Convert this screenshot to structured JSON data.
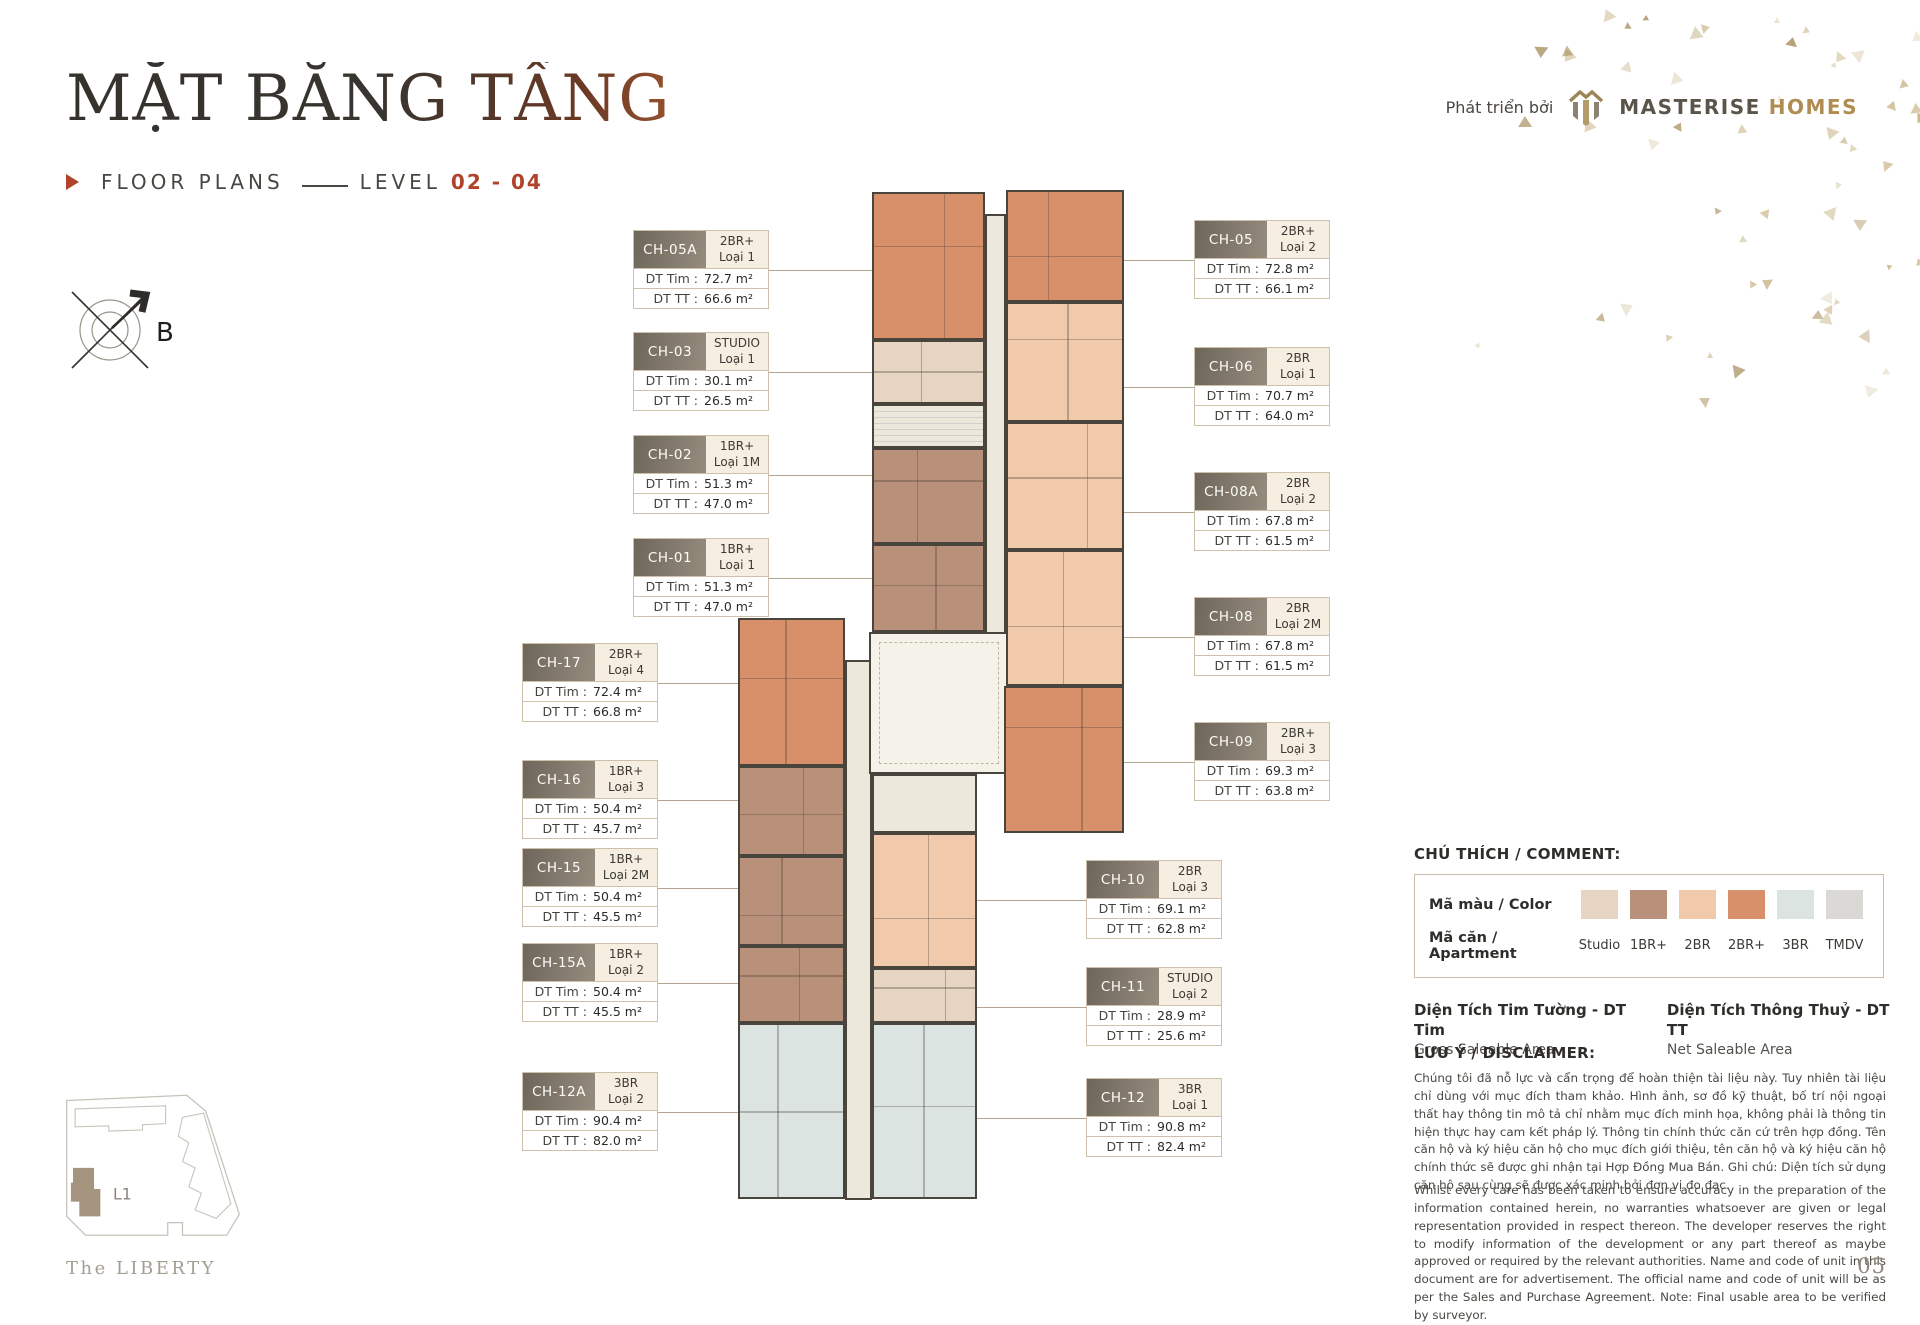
{
  "header": {
    "title": "MẶT BẰNG TẦNG",
    "floor_plans_label": "FLOOR PLANS",
    "level_label": "LEVEL",
    "level_value": "02 - 04",
    "developer_prefix": "Phát triển bởi",
    "brand_word_1": "MASTERISE",
    "brand_word_2": "HOMES"
  },
  "compass": {
    "north_label": "B"
  },
  "unit_row_labels": {
    "dt_tim": "DT Tim :",
    "dt_tt": "DT TT :"
  },
  "units": [
    {
      "code": "CH-05A",
      "type": "2BR+",
      "variant": "Loại 1",
      "dt_tim": "72.7 m²",
      "dt_tt": "66.6 m²"
    },
    {
      "code": "CH-03",
      "type": "STUDIO",
      "variant": "Loại 1",
      "dt_tim": "30.1 m²",
      "dt_tt": "26.5 m²"
    },
    {
      "code": "CH-02",
      "type": "1BR+",
      "variant": "Loại 1M",
      "dt_tim": "51.3 m²",
      "dt_tt": "47.0 m²"
    },
    {
      "code": "CH-01",
      "type": "1BR+",
      "variant": "Loại 1",
      "dt_tim": "51.3 m²",
      "dt_tt": "47.0 m²"
    },
    {
      "code": "CH-17",
      "type": "2BR+",
      "variant": "Loại 4",
      "dt_tim": "72.4 m²",
      "dt_tt": "66.8 m²"
    },
    {
      "code": "CH-16",
      "type": "1BR+",
      "variant": "Loại 3",
      "dt_tim": "50.4 m²",
      "dt_tt": "45.7 m²"
    },
    {
      "code": "CH-15",
      "type": "1BR+",
      "variant": "Loại 2M",
      "dt_tim": "50.4 m²",
      "dt_tt": "45.5 m²"
    },
    {
      "code": "CH-15A",
      "type": "1BR+",
      "variant": "Loại 2",
      "dt_tim": "50.4 m²",
      "dt_tt": "45.5 m²"
    },
    {
      "code": "CH-12A",
      "type": "3BR",
      "variant": "Loại 2",
      "dt_tim": "90.4 m²",
      "dt_tt": "82.0 m²"
    },
    {
      "code": "CH-05",
      "type": "2BR+",
      "variant": "Loại 2",
      "dt_tim": "72.8 m²",
      "dt_tt": "66.1 m²"
    },
    {
      "code": "CH-06",
      "type": "2BR",
      "variant": "Loại 1",
      "dt_tim": "70.7 m²",
      "dt_tt": "64.0 m²"
    },
    {
      "code": "CH-08A",
      "type": "2BR",
      "variant": "Loại 2",
      "dt_tim": "67.8 m²",
      "dt_tt": "61.5 m²"
    },
    {
      "code": "CH-08",
      "type": "2BR",
      "variant": "Loại 2M",
      "dt_tim": "67.8 m²",
      "dt_tt": "61.5 m²"
    },
    {
      "code": "CH-09",
      "type": "2BR+",
      "variant": "Loại 3",
      "dt_tim": "69.3 m²",
      "dt_tt": "63.8 m²"
    },
    {
      "code": "CH-10",
      "type": "2BR",
      "variant": "Loại 3",
      "dt_tim": "69.1 m²",
      "dt_tt": "62.8 m²"
    },
    {
      "code": "CH-11",
      "type": "STUDIO",
      "variant": "Loại 2",
      "dt_tim": "28.9 m²",
      "dt_tt": "25.6 m²"
    },
    {
      "code": "CH-12",
      "type": "3BR",
      "variant": "Loại 1",
      "dt_tim": "90.8 m²",
      "dt_tt": "82.4 m²"
    }
  ],
  "legend": {
    "heading": "CHÚ THÍCH / COMMENT:",
    "color_row_label": "Mã màu / Color",
    "apartment_row_label": "Mã căn / Apartment",
    "items": [
      {
        "label": "Studio",
        "color": "#e6d5c3"
      },
      {
        "label": "1BR+",
        "color": "#b9917b"
      },
      {
        "label": "2BR",
        "color": "#f1c9ab"
      },
      {
        "label": "2BR+",
        "color": "#d8906a"
      },
      {
        "label": "3BR",
        "color": "#dce4e2"
      },
      {
        "label": "TMDV",
        "color": "#dad9d6"
      }
    ]
  },
  "area_definitions": [
    {
      "term": "Diện Tích Tim Tường - DT Tim",
      "definition": "Gross Saleable Area"
    },
    {
      "term": "Diện Tích Thông Thuỷ - DT TT",
      "definition": "Net Saleable Area"
    }
  ],
  "disclaimer": {
    "heading": "LƯU Ý / DISCLAIMER:",
    "paragraph_vi": "Chúng tôi đã nỗ lực và cẩn trọng để hoàn thiện tài liệu này. Tuy nhiên tài liệu chỉ dùng với mục đích tham khảo. Hình ảnh, sơ đồ kỹ thuật, bố trí nội ngoại thất hay thông tin mô tả chỉ nhằm mục đích minh họa, không phải là thông tin hiện thực hay cam kết pháp lý. Thông tin chính thức căn cứ trên hợp đồng. Tên căn hộ và ký hiệu căn hộ cho mục đích giới thiệu, tên căn hộ và ký hiệu căn hộ chính thức sẽ được ghi nhận tại Hợp Đồng Mua Bán. Ghi chú: Diện tích sử dụng căn hộ sau cùng sẽ được xác minh bởi đơn vị đo đạc.",
    "paragraph_en": "Whilst every care has been taken to ensure accuracy in the preparation of the information contained herein, no warranties whatsoever are given or legal representation provided in respect thereon. The developer reserves the right to modify information of the development or any part thereof as maybe approved or required by the relevant authorities. Name and code of unit in this document are for advertisement. The official name and code of unit will be as per the Sales and Purchase Agreement. Note: Final usable area to be verified by surveyor."
  },
  "site_key": {
    "building_label": "L1",
    "project_name": "The LIBERTY"
  },
  "page_number": "05",
  "colors": {
    "accent": "#b0432a",
    "brand_gold": "#b08c52",
    "wall": "#49453d",
    "corridor": "#ece8db",
    "label_header": "#7b7265"
  }
}
